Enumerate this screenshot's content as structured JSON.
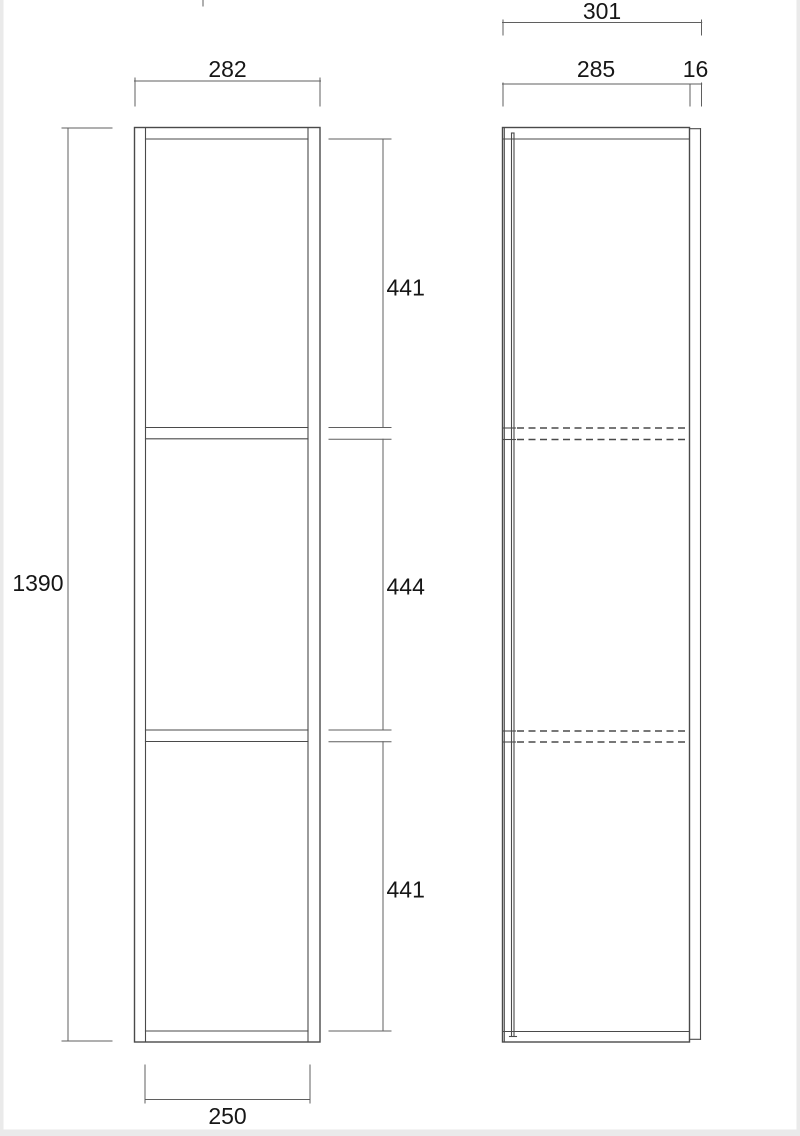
{
  "drawing": {
    "type": "furniture-dimension-drawing",
    "views": {
      "front": {
        "name": "front-view"
      },
      "side": {
        "name": "side-view"
      }
    },
    "dimensions": {
      "front_outer_width": "282",
      "front_inner_width": "250",
      "total_height": "1390",
      "section_top": "441",
      "section_middle": "444",
      "section_bottom": "441",
      "side_total_depth": "301",
      "side_body_depth": "285",
      "back_panel_thickness": "16"
    },
    "colors": {
      "line": "#4a4a4a",
      "dim_line": "#5f5f5f",
      "text": "#161616",
      "page_edge": "#eaeaea"
    }
  }
}
